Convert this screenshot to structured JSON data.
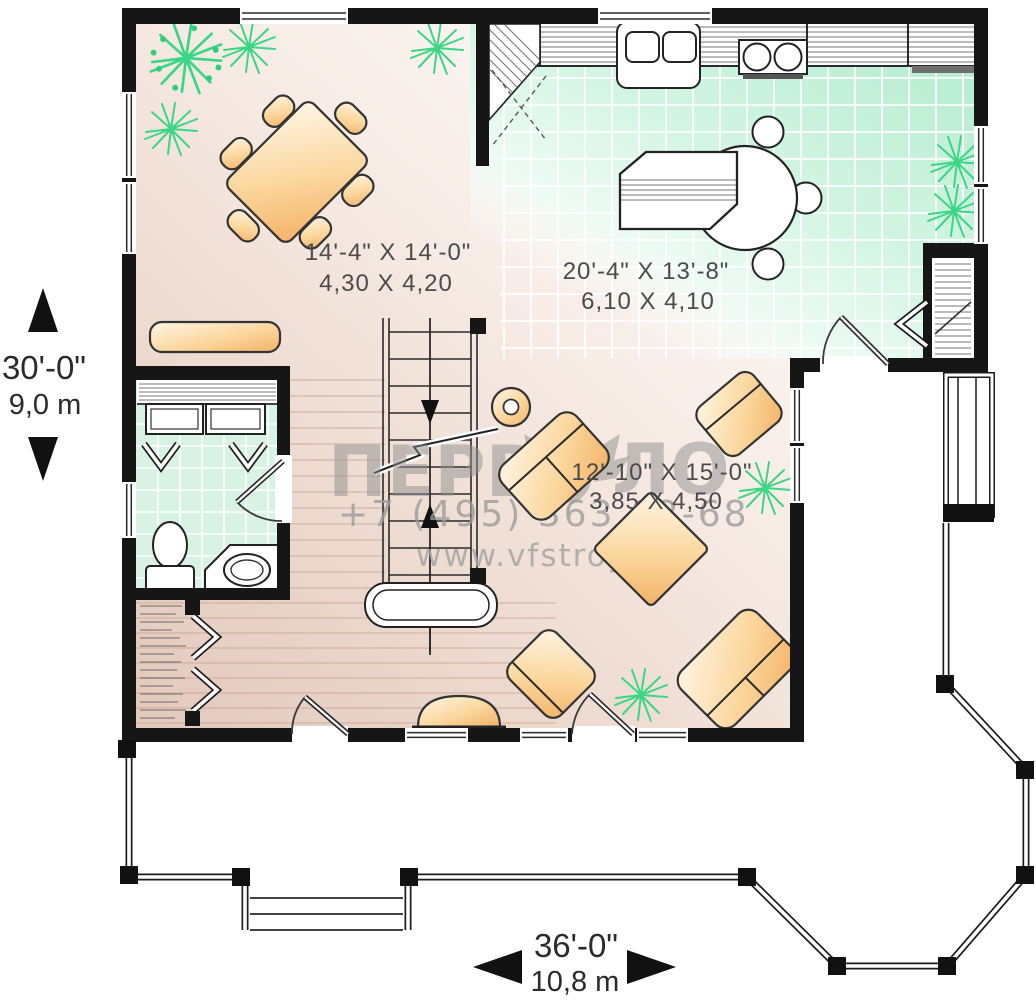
{
  "watermark": {
    "brand_left": "ПЕРВЗ",
    "brand_right": "ЛО",
    "phone": "+7 (495) 363 62-68",
    "url": "www.vfstroy.ru"
  },
  "rooms": {
    "dining": {
      "imperial": "14'-4\" X 14'-0\"",
      "metric": "4,30 X 4,20"
    },
    "kitchen": {
      "imperial": "20'-4\" X 13'-8\"",
      "metric": "6,10 X 4,10"
    },
    "living": {
      "imperial": "12'-10\" X 15'-0\"",
      "metric": "3,85 X 4,50"
    }
  },
  "dimensions": {
    "height": {
      "imperial": "30'-0\"",
      "metric": "9,0 m"
    },
    "width": {
      "imperial": "36'-0\"",
      "metric": "10,8 m"
    }
  },
  "colors": {
    "wall": "#161616",
    "tile_green": "#c9f2dc",
    "floor_pink": "#e9d4c9",
    "furniture_tan": "#f6bb70",
    "plant_green": "#3bd685",
    "watermark_gray": "#9a9a9a"
  }
}
